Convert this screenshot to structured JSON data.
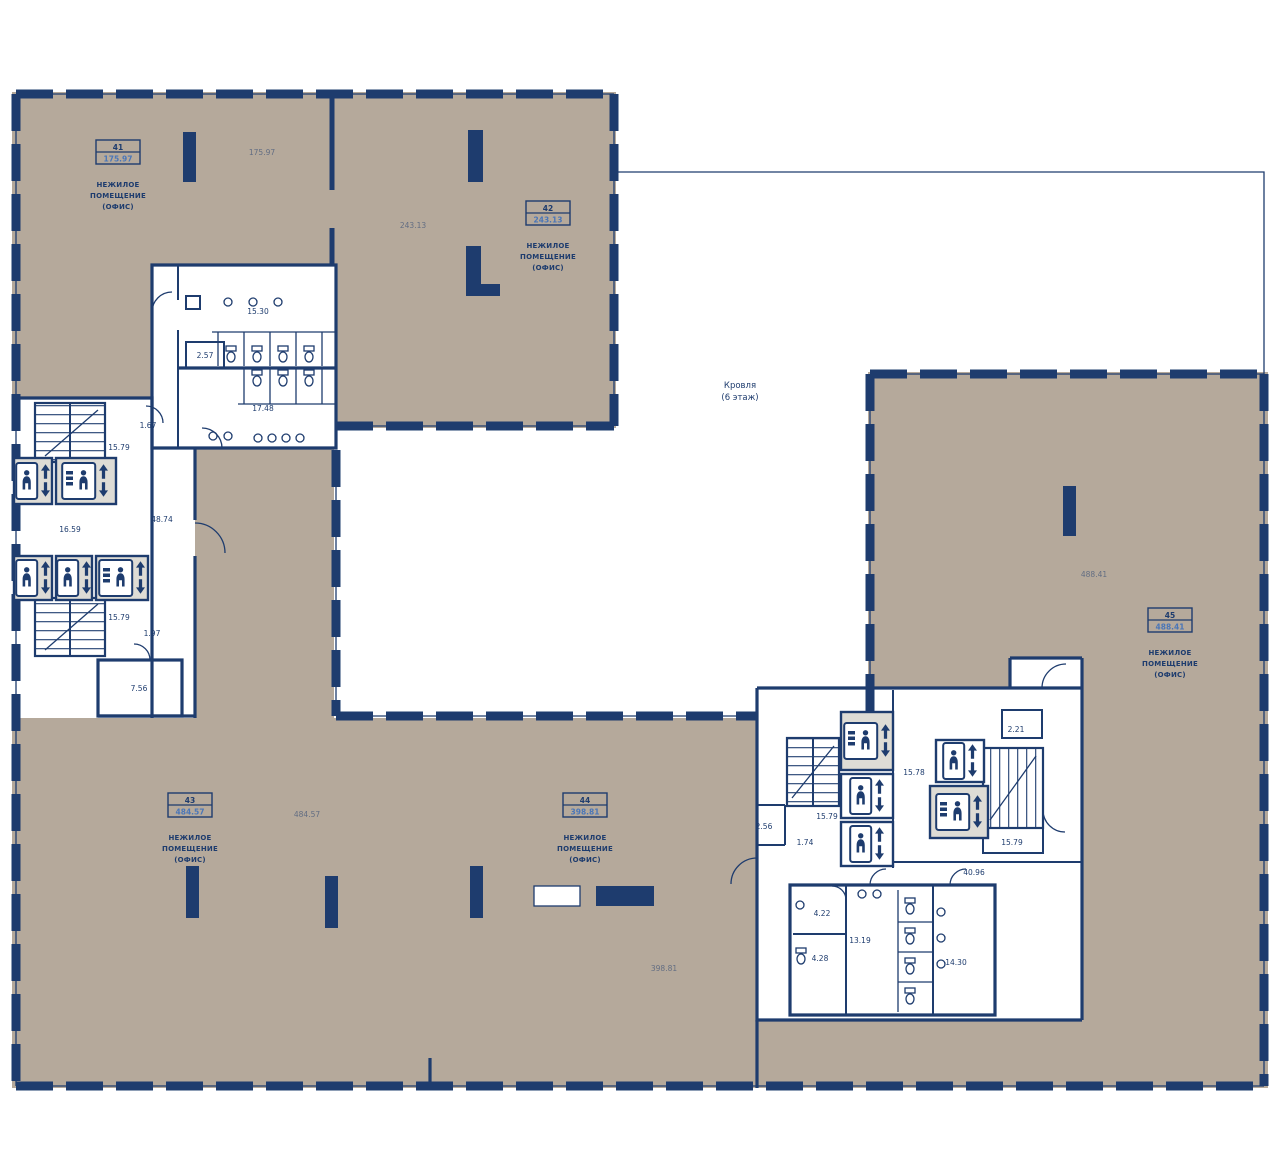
{
  "colors": {
    "wall": "#1e3c6e",
    "accent": "#4a76b8",
    "floor": "#b5a99b",
    "cabin": "#dedcd5"
  },
  "roof_label": {
    "line1": "Кровля",
    "line2": "(6 этаж)"
  },
  "room_type": {
    "line1": "НЕЖИЛОЕ",
    "line2": "ПОМЕЩЕНИЕ",
    "line3": "(ОФИС)"
  },
  "rooms": [
    {
      "number": "41",
      "area": "175.97"
    },
    {
      "number": "42",
      "area": "243.13"
    },
    {
      "number": "43",
      "area": "484.57"
    },
    {
      "number": "44",
      "area": "398.81"
    },
    {
      "number": "45",
      "area": "488.41"
    }
  ],
  "annotations": [
    "175.97",
    "243.13",
    "15.30",
    "2.57",
    "17.48",
    "1.67",
    "15.79",
    "16.59",
    "48.74",
    "15.79",
    "1.97",
    "7.56",
    "484.57",
    "398.81",
    "488.41",
    "2.56",
    "15.79",
    "1.74",
    "15.78",
    "2.21",
    "15.79",
    "40.96",
    "4.22",
    "4.28",
    "13.19",
    "14.30"
  ],
  "icons": {
    "passenger_elevator": "person-in-elevator",
    "freight_elevator": "panel-and-person-in-elevator",
    "direction_arrows": "↑↓"
  }
}
